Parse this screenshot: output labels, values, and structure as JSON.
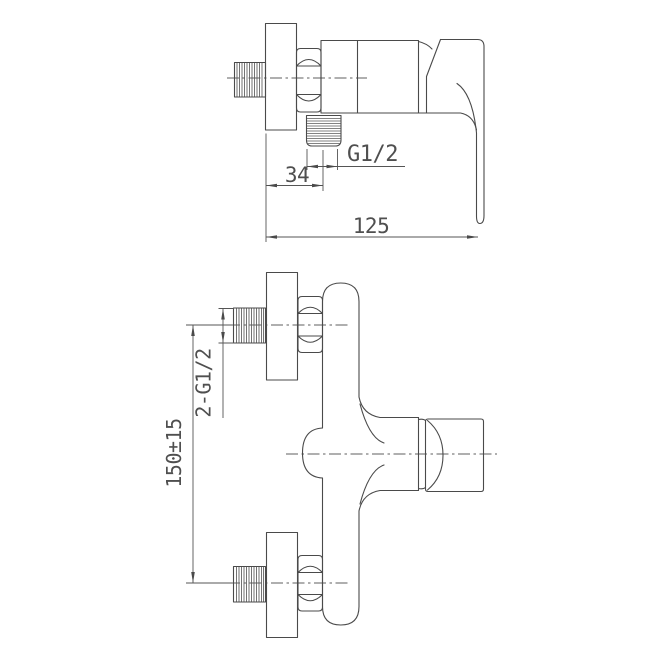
{
  "drawing": {
    "description": "Two-view technical line drawing of a wall-mounted single-lever shower mixer tap",
    "colors": {
      "background": "#ffffff",
      "line": "#4a4a4a",
      "text": "#4f4f4f"
    },
    "labels": {
      "outlet_thread": "G1/2",
      "outlet_offset": "34",
      "overall_depth": "125",
      "inlet_threads": "2-G1/2",
      "inlet_spacing": "150±15"
    }
  }
}
